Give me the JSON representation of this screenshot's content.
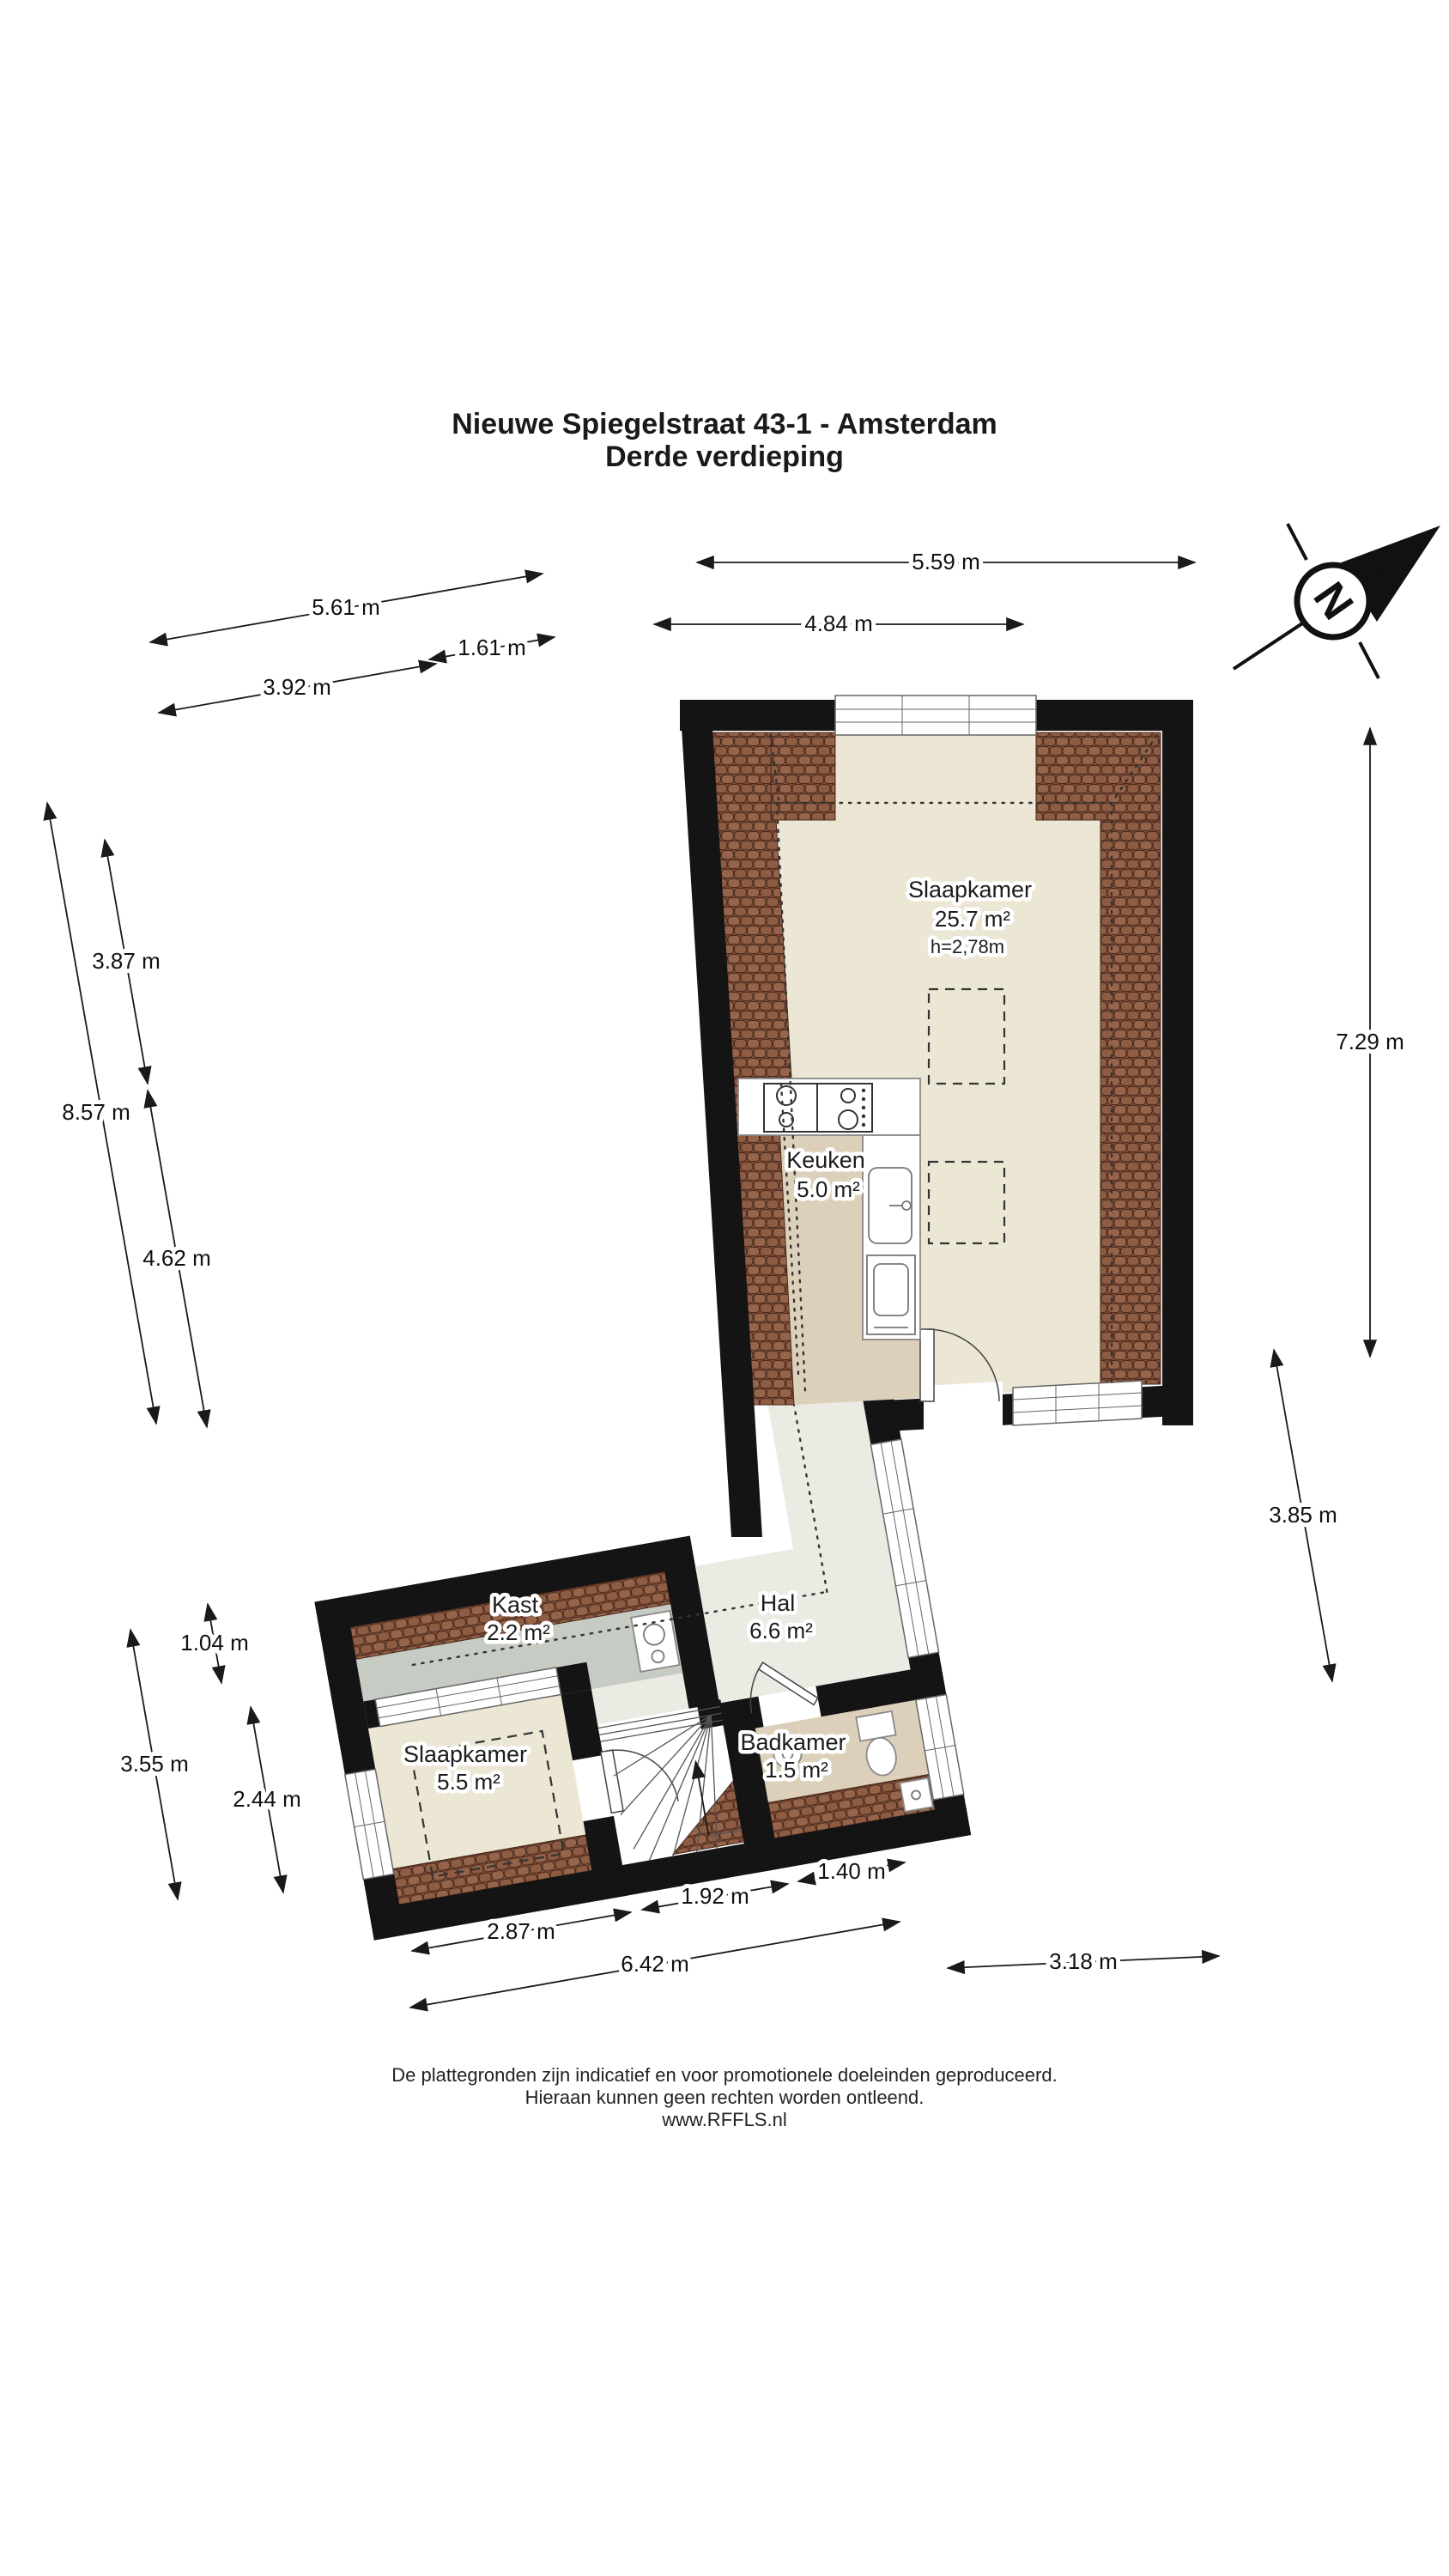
{
  "title": {
    "line1": "Nieuwe Spiegelstraat 43-1 - Amsterdam",
    "line2": "Derde verdieping"
  },
  "compass": {
    "letter": "N"
  },
  "rooms": {
    "slaapkamer_groot": {
      "name": "Slaapkamer",
      "area": "25.7 m²",
      "ceiling_height": "h=2,78m"
    },
    "keuken": {
      "name": "Keuken",
      "area": "5.0 m²"
    },
    "kast": {
      "name": "Kast",
      "area": "2.2 m²"
    },
    "hal": {
      "name": "Hal",
      "area": "6.6 m²"
    },
    "slaapkamer_klein": {
      "name": "Slaapkamer",
      "area": "5.5 m²"
    },
    "badkamer": {
      "name": "Badkamer",
      "area": "1.5 m²"
    }
  },
  "dims": {
    "d5_59": "5.59 m",
    "d4_84": "4.84 m",
    "d5_61": "5.61 m",
    "d1_61": "1.61 m",
    "d3_92": "3.92 m",
    "d3_87": "3.87 m",
    "d8_57": "8.57 m",
    "d4_62": "4.62 m",
    "d7_29": "7.29 m",
    "d3_85": "3.85 m",
    "d1_04": "1.04 m",
    "d3_55": "3.55 m",
    "d2_44": "2.44 m",
    "d2_87": "2.87 m",
    "d1_92": "1.92 m",
    "d1_40": "1.40 m",
    "d6_42": "6.42 m",
    "d3_18": "3.18 m"
  },
  "footer": {
    "line1": "De plattegronden zijn indicatief en voor promotionele doeleinden geproduceerd.",
    "line2": "Hieraan kunnen geen rechten worden ontleend.",
    "line3": "www.RFFLS.nl"
  },
  "colors": {
    "wall": "#141414",
    "floor_cream": "#ece6d5",
    "floor_tan": "#ddd0ba",
    "floor_hal": "#ebeae3",
    "floor_kast": "#c6cbc3",
    "brick_base": "#7d4c38",
    "brick_tile": "#95644a"
  }
}
